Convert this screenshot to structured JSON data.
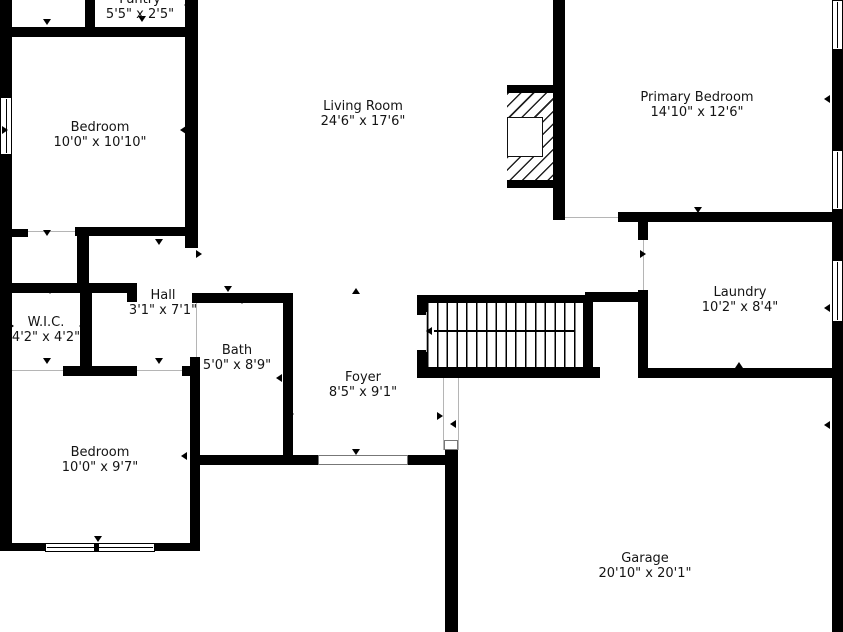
{
  "colors": {
    "wall": "#000000",
    "background": "#ffffff",
    "text": "#141414"
  },
  "icons": {
    "door_marker": "small black triangle",
    "stair_direction": "left arrow"
  },
  "rooms": [
    {
      "name": "Pantry",
      "dims": "5'5\" x 2'5\""
    },
    {
      "name": "Bedroom",
      "dims": "10'0\" x 10'10\""
    },
    {
      "name": "Living Room",
      "dims": "24'6\" x 17'6\""
    },
    {
      "name": "Primary Bedroom",
      "dims": "14'10\" x 12'6\""
    },
    {
      "name": "Hall",
      "dims": "3'1\" x 7'1\""
    },
    {
      "name": "W.I.C.",
      "dims": "4'2\" x 4'2\""
    },
    {
      "name": "Bath",
      "dims": "5'0\" x 8'9\""
    },
    {
      "name": "Foyer",
      "dims": "8'5\" x 9'1\""
    },
    {
      "name": "Laundry",
      "dims": "10'2\" x 8'4\""
    },
    {
      "name": "Bedroom",
      "dims": "10'0\" x 9'7\""
    },
    {
      "name": "Garage",
      "dims": "20'10\" x 20'1\""
    }
  ]
}
